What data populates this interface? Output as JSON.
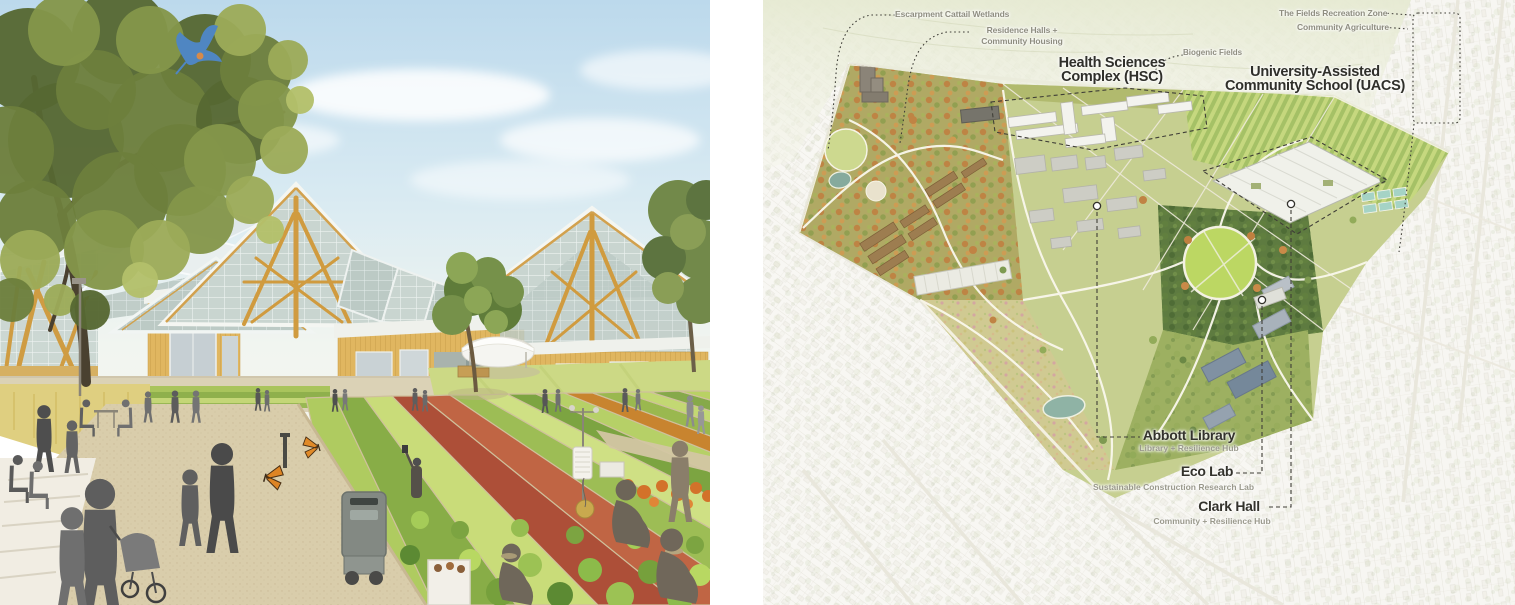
{
  "page": {
    "background": "#ffffff"
  },
  "palette": {
    "label_primary": "#2f2f2a",
    "label_secondary": "#8e8d80",
    "leader_line": "#3f3e37",
    "timber_amber": "#d09b3f",
    "wood_siding": "#e0b660",
    "glass": "#c9d5d0",
    "foliage_green": "#6d7f3c",
    "crop_green": "#a9c45c",
    "crop_red": "#ad4f38",
    "crop_orange": "#c8842f",
    "path_beige": "#d9cdab",
    "pond_teal": "#8fb3a5",
    "lawn_green": "#bcd763",
    "campus_base": "#c6cf90",
    "city_paper": "#f7f6f1"
  },
  "map": {
    "annotations": {
      "wetlands": {
        "text": "Escarpment Cattail Wetlands"
      },
      "residence": {
        "line1": "Residence Halls +",
        "line2": "Community Housing"
      },
      "hsc": {
        "line1": "Health Sciences",
        "line2": "Complex (HSC)"
      },
      "biogenic": {
        "text": "Biogenic Fields"
      },
      "fields_zone": {
        "text": "The Fields Recreation Zone"
      },
      "community_ag": {
        "text": "Community Agriculture"
      },
      "uacs": {
        "line1": "University-Assisted",
        "line2": "Community School (UACS)"
      },
      "abbott": {
        "title": "Abbott Library",
        "subtitle": "Library + Resilience Hub"
      },
      "ecolab": {
        "title": "Eco Lab",
        "subtitle": "Sustainable Construction Research Lab"
      },
      "clark": {
        "title": "Clark Hall",
        "subtitle": "Community + Resilience Hub"
      }
    }
  }
}
